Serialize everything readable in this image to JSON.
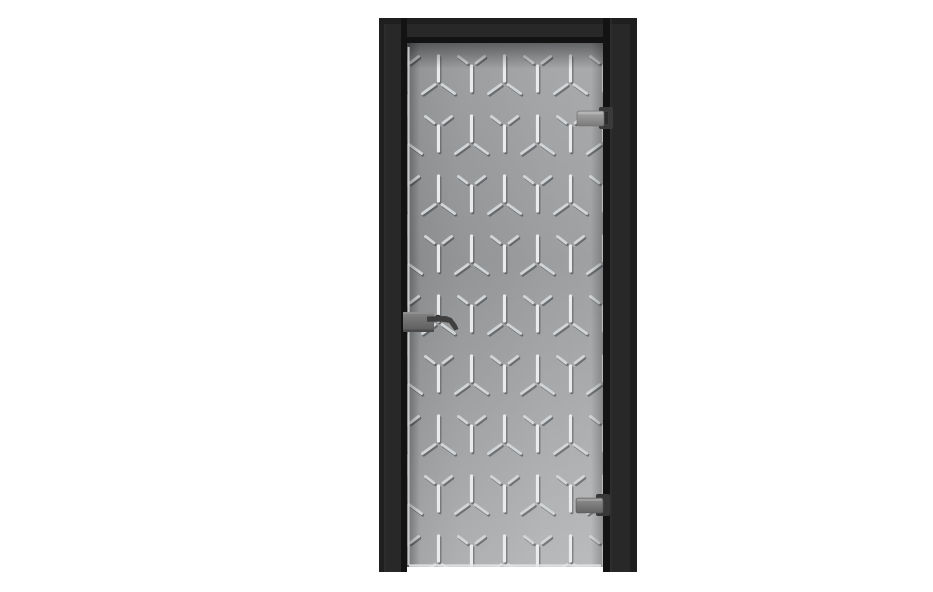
{
  "image": {
    "type": "product-photo",
    "subject": "Frameless grey glass interior door with etched Y cube lattice pattern, black door frame, lever handle with lock plate on left edge, two glass clamp hinges on right edge",
    "background_color": "#ffffff",
    "width": 933,
    "height": 560
  },
  "frame": {
    "color_face": "#282828",
    "color_outer": "#1f1f1f",
    "color_reveal": "#131313",
    "outer_x": 339,
    "outer_y": 2,
    "outer_w": 258,
    "outer_h": 554,
    "head_h": 25,
    "left_jamb_w": 28,
    "right_jamb_w": 34
  },
  "glass": {
    "x": 367,
    "y": 27,
    "w": 196,
    "h": 524,
    "gradient_top": "#a3a5a7",
    "gradient_mid": "#97999b",
    "gradient_bottom": "#b5b6b7",
    "edge_highlight": "#d8dadc",
    "corner_shadow": "rgba(0,0,0,0.42)"
  },
  "pattern": {
    "name": "etched-y-cube-lattice",
    "col_spacing": 33,
    "row_spacing": 60,
    "bar_length": 25,
    "bar_width": 3.2,
    "diag_width": 2.9,
    "bright_color": "#e9ebec",
    "diag_color": "#d2d5d7",
    "shadow_color": "rgba(40,42,44,0.45)",
    "origin_x": 382,
    "origin_y": 40
  },
  "hardware": {
    "handle": {
      "part": "lever-handle-with-lock-plate",
      "plate_x": 363,
      "plate_y": 296,
      "plate_w": 31,
      "plate_h": 20,
      "plate_color_light": "#848484",
      "plate_color_dark": "#5a5a5a",
      "lever_color": "#3f3f3f"
    },
    "hinge_top": {
      "part": "glass-clamp-hinge",
      "clamp_x": 537,
      "clamp_y": 95,
      "clamp_w": 27,
      "clamp_h": 15,
      "clamp_color_light": "#a8a8a8",
      "clamp_color_dark": "#7a7a7a",
      "bracket_x": 559,
      "bracket_y": 91,
      "bracket_w": 14,
      "bracket_h": 22,
      "bracket_color": "#3a3a3a"
    },
    "hinge_bottom": {
      "part": "glass-clamp-hinge",
      "clamp_x": 536,
      "clamp_y": 482,
      "clamp_w": 27,
      "clamp_h": 15,
      "clamp_color_light": "#8f8f8f",
      "clamp_color_dark": "#646464",
      "bracket_x": 556,
      "bracket_y": 478,
      "bracket_w": 14,
      "bracket_h": 22,
      "bracket_color": "#383838"
    }
  }
}
